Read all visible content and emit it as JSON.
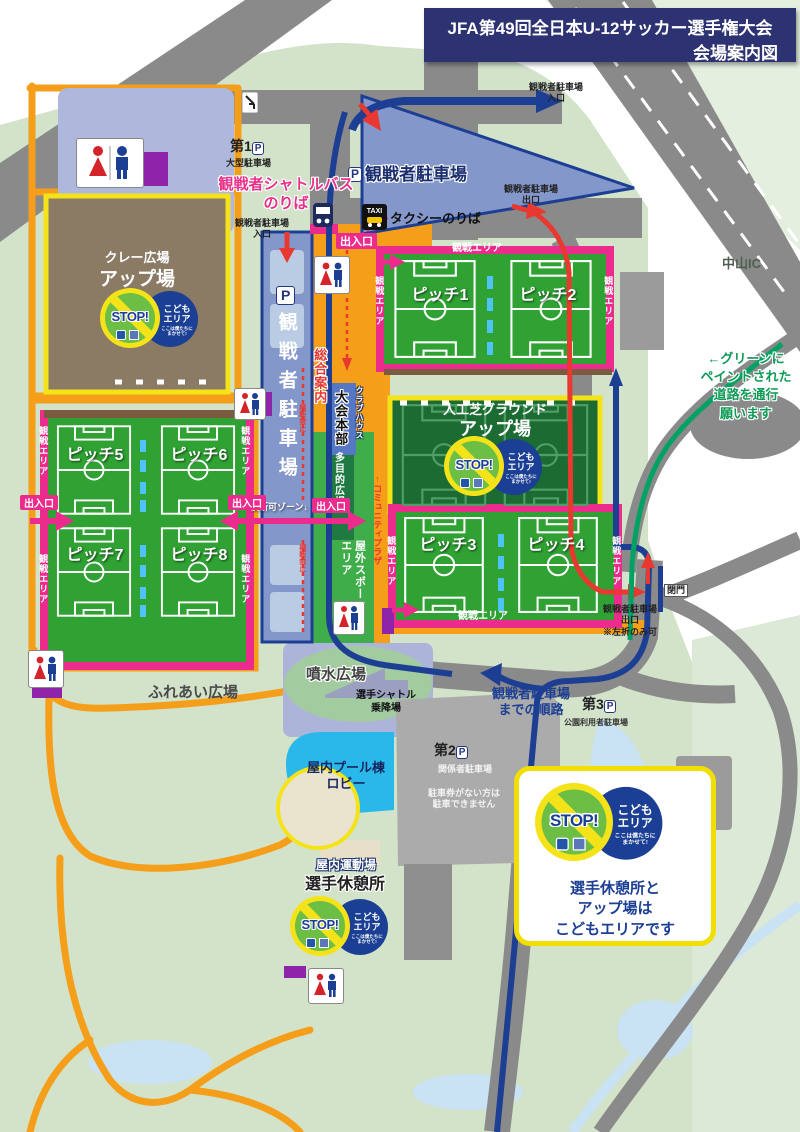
{
  "title": {
    "line1": "JFA第49回全日本U-12サッカー選手権大会",
    "line2": "会場案内図"
  },
  "roads": {
    "nakayama_ic": "中山IC",
    "green_note": "←グリーンに\nペイントされた\n道路を通行\n願います"
  },
  "parking": {
    "p_letter": "P",
    "p1": {
      "name": "第1",
      "sub": "大型駐車場"
    },
    "p2": {
      "name": "第2",
      "sub": "関係者駐車場",
      "note": "駐車券がない方は\n駐車できません"
    },
    "p3": {
      "name": "第3",
      "sub": "公園利用者駐車場"
    },
    "spectator_label": "観戦者駐車場",
    "entrance": "観戦者駐車場\n入口",
    "exit": "観戦者駐車場\n出口",
    "exit_left_only": "観戦者駐車場\n出口\n※左折のみ可",
    "route_note": "観戦者駐車場\nまでの順路",
    "arrow_up": "↑"
  },
  "transport": {
    "shuttle_stop": "観戦者シャトルバス\nのりば",
    "taxi_stand": "タクシーのりば",
    "taxi_icon": "TAXI",
    "player_shuttle": "選手シャトル\n乗降場"
  },
  "areas": {
    "clay_name": "クレー広場",
    "clay_sub": "アップ場",
    "turf_name": "人工芝グラウンド",
    "turf_sub": "アップ場",
    "info": "総合案内",
    "clubhouse": "クラブハウス",
    "hq": "大会本部",
    "multi_plaza": "多目的広場",
    "outdoor_sports": "屋外スポーツ\nエリア",
    "community_plaza": "↑コミュニティプラザ",
    "fountain": "噴水広場",
    "fureai": "ふれあい広場",
    "pool": "屋内プール棟\nロビー",
    "indoor_gym": "屋内運動場",
    "rest_area": "選手休憩所"
  },
  "pitches": {
    "1": "ピッチ1",
    "2": "ピッチ2",
    "3": "ピッチ3",
    "4": "ピッチ4",
    "5": "ピッチ5",
    "6": "ピッチ6",
    "7": "ピッチ7",
    "8": "ピッチ8"
  },
  "badges": {
    "gate": "出入口",
    "spectate_area": "観戦エリア",
    "closed_gate": "閉門",
    "cross_ok": "横断可ゾーン↓",
    "no_cross": "横断禁止"
  },
  "stop_sign": {
    "stop": "STOP!",
    "kids_label": "こども\nエリア",
    "kids_small": "ここは僕たちに\nまかせて!"
  },
  "legend": {
    "note": "選手休憩所と\nアップ場は\nこどもエリアです"
  },
  "colors": {
    "title_navy": "#2D3272",
    "route_blue": "#1C3F94",
    "route_red": "#E8382F",
    "route_green": "#00A263",
    "accent_pink": "#EC2C8C",
    "path_orange": "#F59E19",
    "field_green": "#2FA233",
    "turf_green": "#1C6B33",
    "clay_brown": "#8B7A64",
    "parking_blue": "#8497CA",
    "sign_yellow": "#F5E31A",
    "sign_green": "#6CBE45"
  }
}
